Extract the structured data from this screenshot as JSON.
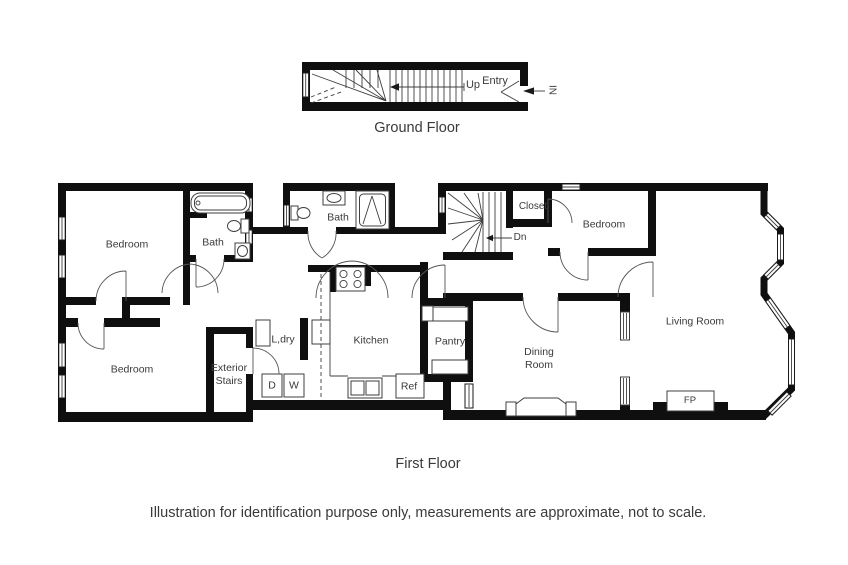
{
  "page": {
    "background_color": "#ffffff",
    "wall_color": "#0f0f0f",
    "line_color": "#3f3f3f",
    "text_color": "#3a3a3a"
  },
  "ground_floor": {
    "title": "Ground Floor",
    "labels": {
      "up": "Up",
      "entry": "Entry",
      "in_direction": "IN"
    }
  },
  "first_floor": {
    "title": "First Floor",
    "rooms": {
      "bedroom_top_left": "Bedroom",
      "bath_left": "Bath",
      "bath_middle": "Bath",
      "closet": "Closet",
      "bedroom_top_right": "Bedroom",
      "living_room": "Living Room",
      "bedroom_bottom_left": "Bedroom",
      "exterior_stairs_line1": "Exterior",
      "exterior_stairs_line2": "Stairs",
      "laundry": "L,dry",
      "kitchen": "Kitchen",
      "pantry": "Pantry",
      "dining_room_line1": "Dining",
      "dining_room_line2": "Room",
      "dryer": "D",
      "washer": "W",
      "refrigerator": "Ref",
      "fireplace": "FP",
      "stairs_down": "Dn"
    }
  },
  "footer": {
    "disclaimer": "Illustration for identification purpose only, measurements are approximate, not to scale."
  }
}
